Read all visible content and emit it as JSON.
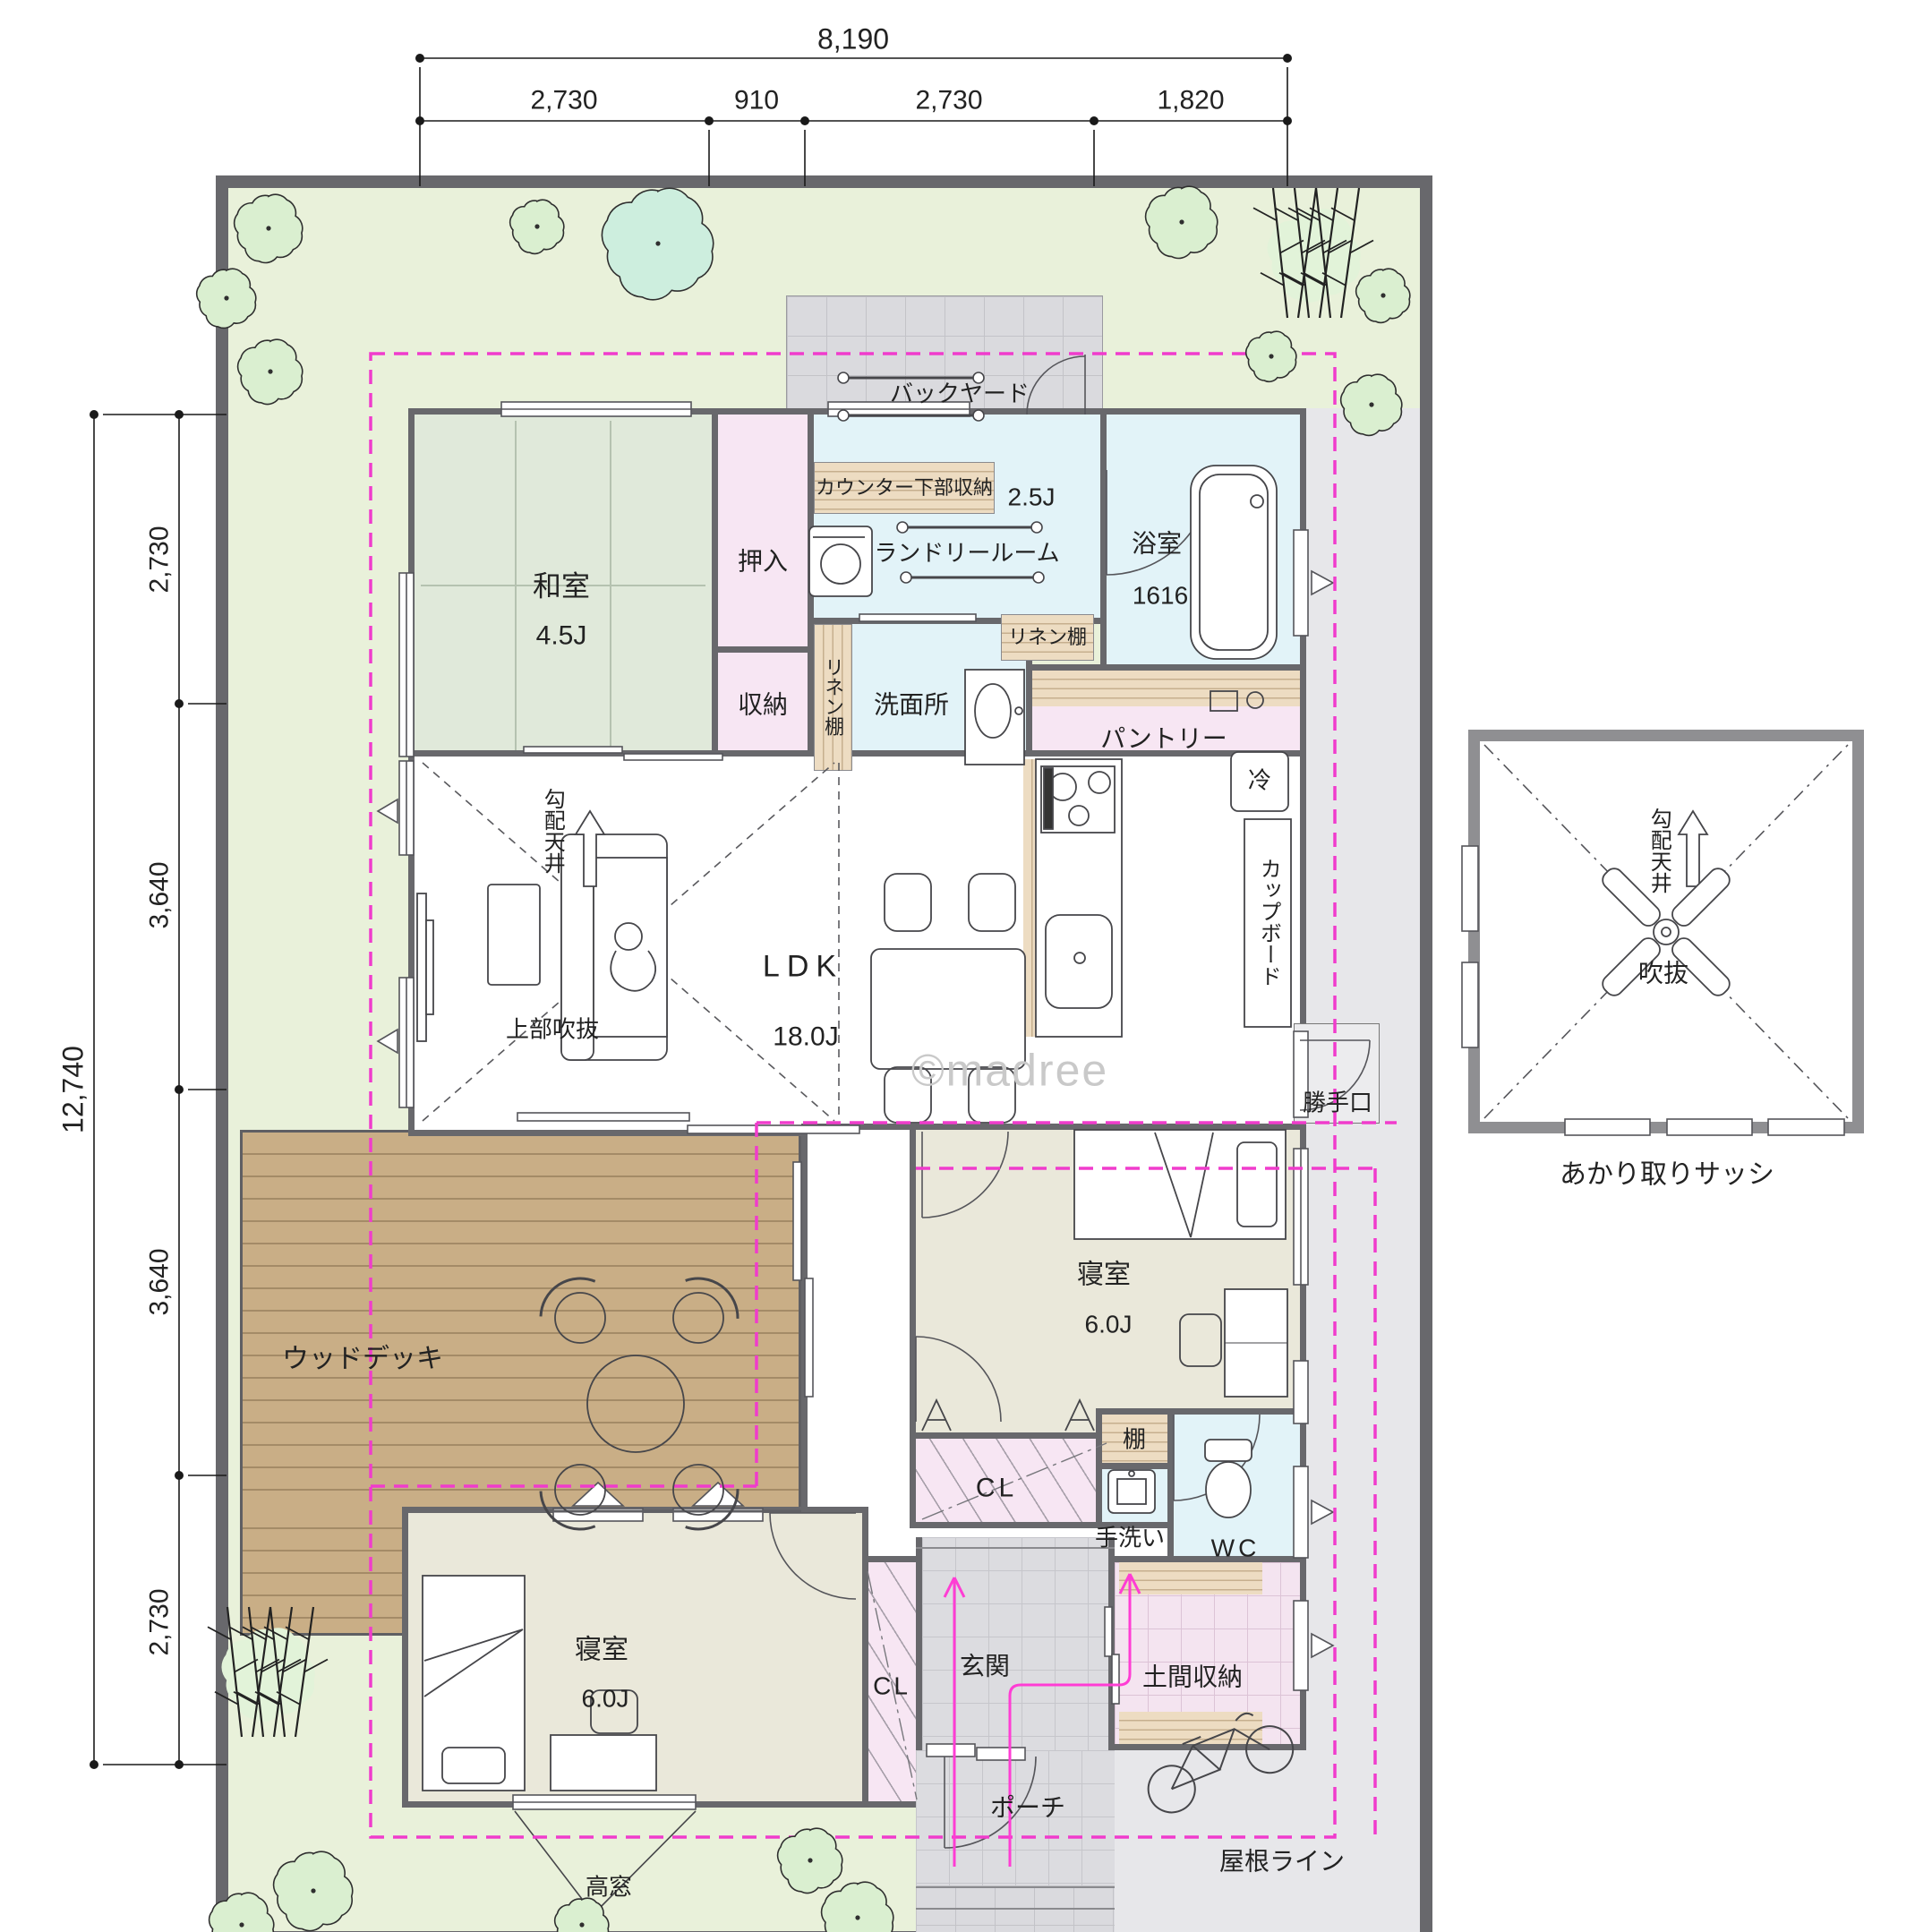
{
  "watermark": "©madree",
  "dimensions": {
    "top": {
      "total": "8,190",
      "segments": [
        "2,730",
        "910",
        "2,730",
        "1,820"
      ]
    },
    "left": {
      "total": "12,740",
      "segments": [
        "2,730",
        "3,640",
        "3,640",
        "2,730"
      ]
    }
  },
  "rooms": {
    "washitsu": {
      "name": "和室",
      "size": "4.5J"
    },
    "oshiire": {
      "name": "押入"
    },
    "shunou": {
      "name": "収納"
    },
    "counter_storage": {
      "name": "カウンター下部収納"
    },
    "laundry": {
      "name": "ランドリールーム",
      "size": "2.5J"
    },
    "linen_shelf_1": {
      "name": "リネン棚"
    },
    "linen_shelf_2": {
      "name": "リネン棚"
    },
    "senmenjo": {
      "name": "洗面所"
    },
    "bathroom": {
      "name": "浴室",
      "size": "1616"
    },
    "pantry": {
      "name": "パントリー"
    },
    "ldk": {
      "name": "LDK",
      "size": "18.0J"
    },
    "upper_void": {
      "name": "上部吹抜"
    },
    "sloped_ceiling": {
      "name": "勾配天井"
    },
    "fridge": {
      "name": "冷"
    },
    "cupboard": {
      "name": "カップボード"
    },
    "back_door": {
      "name": "勝手口"
    },
    "wood_deck": {
      "name": "ウッドデッキ"
    },
    "bedroom1": {
      "name": "寝室",
      "size": "6.0J"
    },
    "closet1": {
      "name": "CL"
    },
    "shelf": {
      "name": "棚"
    },
    "hand_wash": {
      "name": "手洗い"
    },
    "wc": {
      "name": "WC"
    },
    "bedroom2": {
      "name": "寝室",
      "size": "6.0J"
    },
    "closet2": {
      "name": "CL"
    },
    "genkan": {
      "name": "玄関"
    },
    "doma_storage": {
      "name": "土間収納"
    },
    "porch": {
      "name": "ポーチ"
    },
    "backyard": {
      "name": "バックヤード"
    }
  },
  "annotations": {
    "high_window": "高窓",
    "roof_line": "屋根ライン"
  },
  "sub_diagram": {
    "void": "吹抜",
    "sloped_ceiling": "勾配天井",
    "caption": "あかり取りサッシ"
  },
  "colors": {
    "roof_line": "#f03ccc",
    "wall": "#68686c",
    "site_green": "#e9f1da",
    "water_blue": "#e2f3f8",
    "closet_pink": "#f7e6f3",
    "tatami_green": "#e0e9da",
    "deck_wood": "#c9ae86"
  }
}
